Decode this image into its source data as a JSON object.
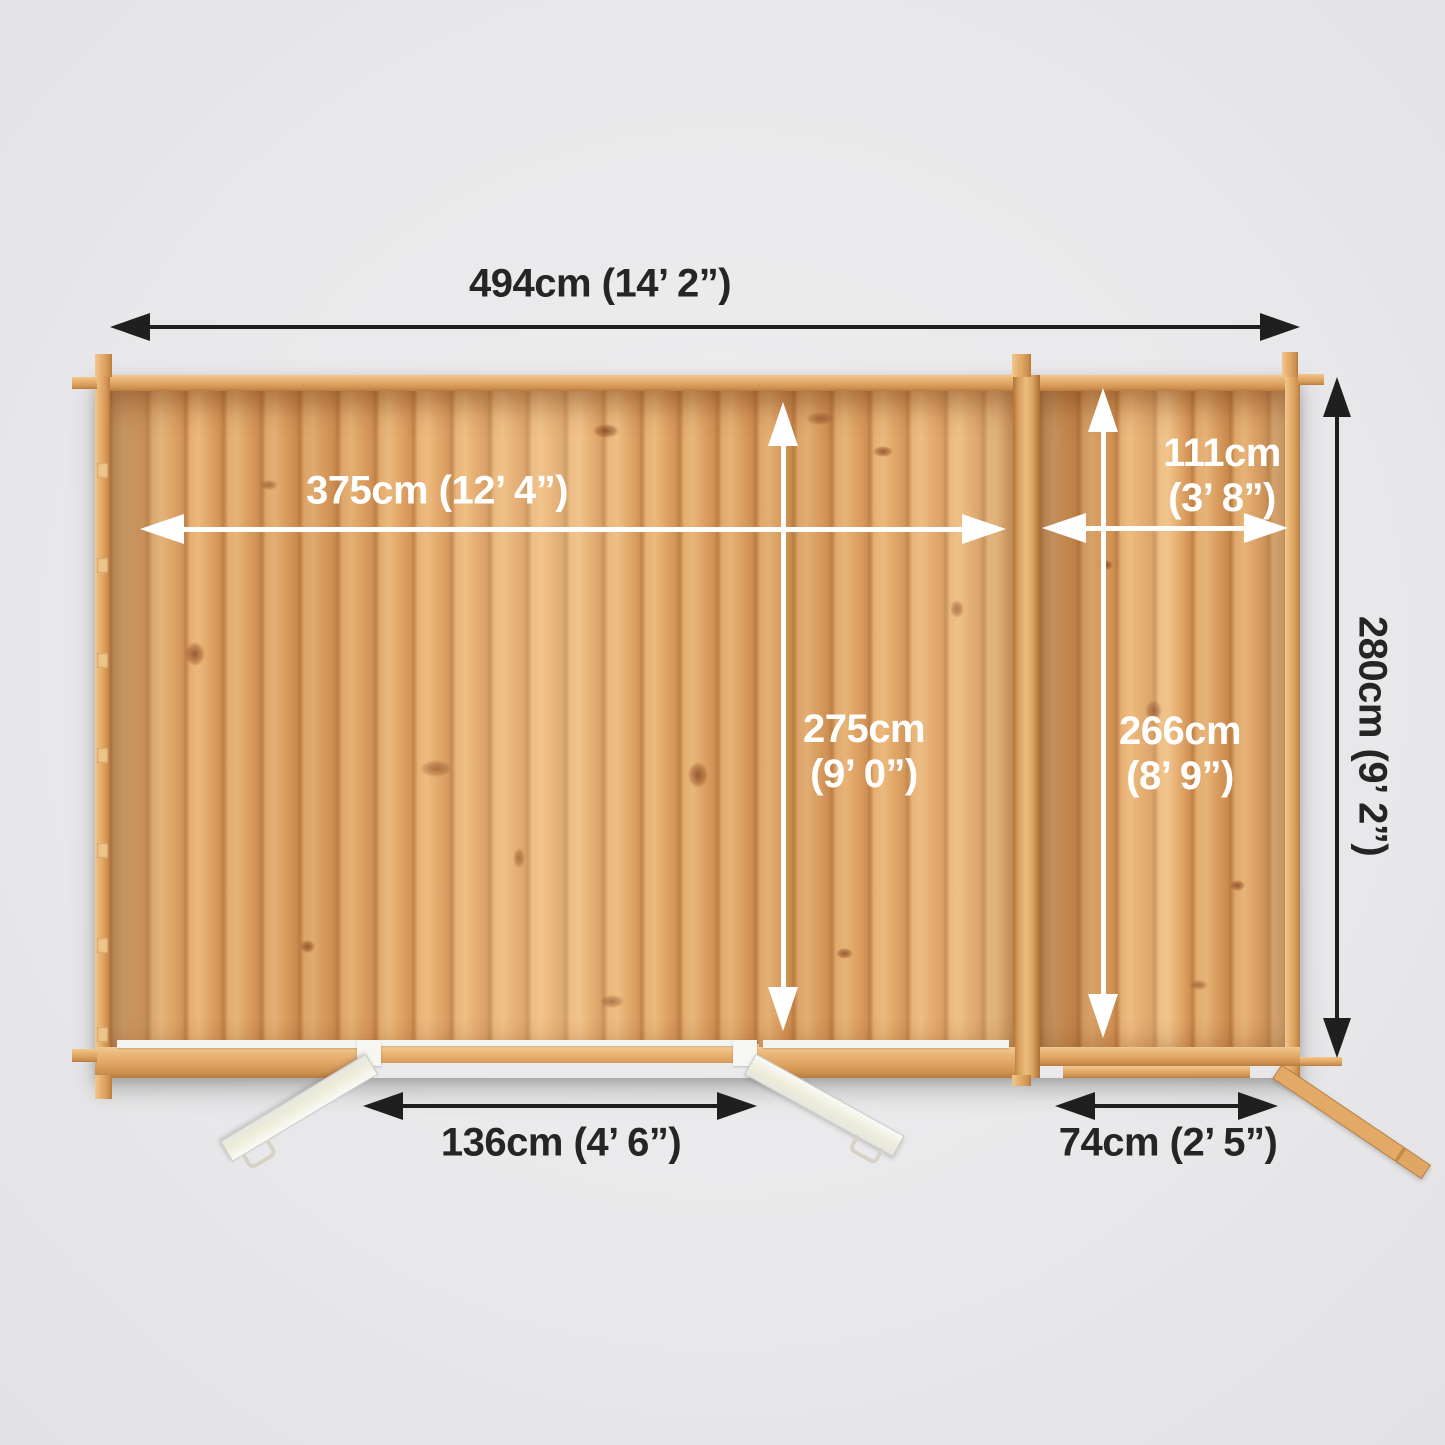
{
  "colors": {
    "background": "#e9e9eb",
    "wood_floor": "#e2a96c",
    "wood_wall": "#e0a765",
    "arrow_black": "#1f1f1f",
    "arrow_white": "#ffffff",
    "label_dark": "#252525",
    "label_light": "#ffffff",
    "door_white": "#f1f1ef"
  },
  "diagram": {
    "type": "top-down floor plan of log cabin with side annex, open doors at front",
    "labels": {
      "overall_width": "494cm (14’ 2”)",
      "overall_depth": "280cm (9’ 2”)",
      "main_internal_width": "375cm (12’ 4”)",
      "main_internal_depth_line1": "275cm",
      "main_internal_depth_line2": "(9’ 0”)",
      "annex_internal_width_line1": "111cm",
      "annex_internal_width_line2": "(3’ 8”)",
      "annex_internal_depth_line1": "266cm",
      "annex_internal_depth_line2": "(8’ 9”)",
      "main_door_width": "136cm (4’ 6”)",
      "annex_door_width": "74cm (2’ 5”)"
    }
  }
}
